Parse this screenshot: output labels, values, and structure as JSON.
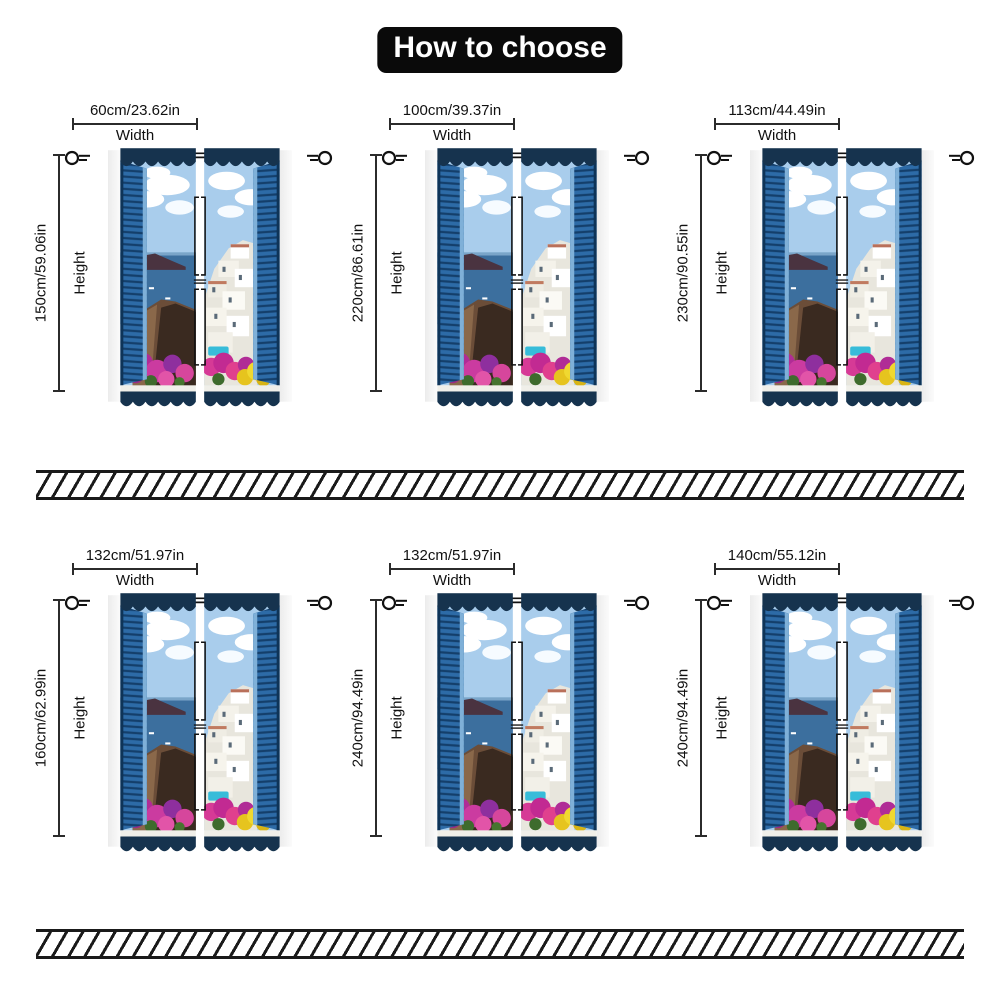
{
  "title": "How to choose",
  "labels": {
    "width": "Width",
    "height": "Height"
  },
  "units": [
    {
      "width": "60cm/23.62in",
      "height": "150cm/59.06in"
    },
    {
      "width": "100cm/39.37in",
      "height": "220cm/86.61in"
    },
    {
      "width": "113cm/44.49in",
      "height": "230cm/90.55in"
    },
    {
      "width": "132cm/51.97in",
      "height": "160cm/62.99in"
    },
    {
      "width": "132cm/51.97in",
      "height": "240cm/94.49in"
    },
    {
      "width": "140cm/55.12in",
      "height": "240cm/94.49in"
    }
  ],
  "icons": {
    "curtain_ring": "curtain-ring-icon (circle with rod lines)"
  },
  "curtain_image": "Two-panel curtain printed with open blue-shutter window overlooking Santorini sea, white village and bougainvillea flowers",
  "colors": {
    "title_bg": "#0a0a0a",
    "title_text": "#ffffff",
    "dimension_line": "#2b2b2b",
    "hatch_stripe": "#1a1a1a",
    "valance_navy": "#16334e",
    "shutter_blue": "#2d6ba7",
    "sky_blue": "#a9cdec",
    "sea_blue": "#3c6f9e",
    "cliff_brown": "#6b4d38",
    "flower_magenta": "#c22a92",
    "flower_yellow": "#e6c41e",
    "pool_cyan": "#37bcd9"
  }
}
